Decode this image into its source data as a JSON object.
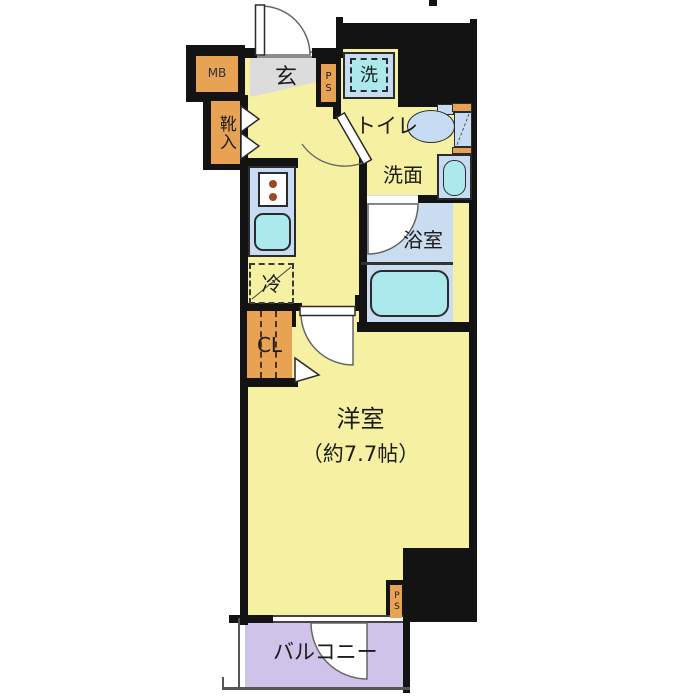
{
  "floorplan": {
    "rooms": {
      "genkan": "玄",
      "meter_box": "MB",
      "shoe_storage": "靴入",
      "pipe_space_top": "PS",
      "washer": "洗",
      "toilet": "トイレ",
      "washroom": "洗面",
      "bathroom": "浴室",
      "fridge": "冷",
      "closet": "CL",
      "main_room": "洋室",
      "main_room_size": "（約7.7帖）",
      "pipe_space_bottom": "PS",
      "balcony": "バルコニー"
    },
    "colors": {
      "wall": "#131313",
      "floor_yellow": "#F6F0A2",
      "entry_gray": "#DCDCDC",
      "fixture_blue": "#C7DCF2",
      "water_cyan": "#ABE9EC",
      "storage_orange": "#E8A254",
      "balcony_purple": "#CFC3E9"
    }
  }
}
